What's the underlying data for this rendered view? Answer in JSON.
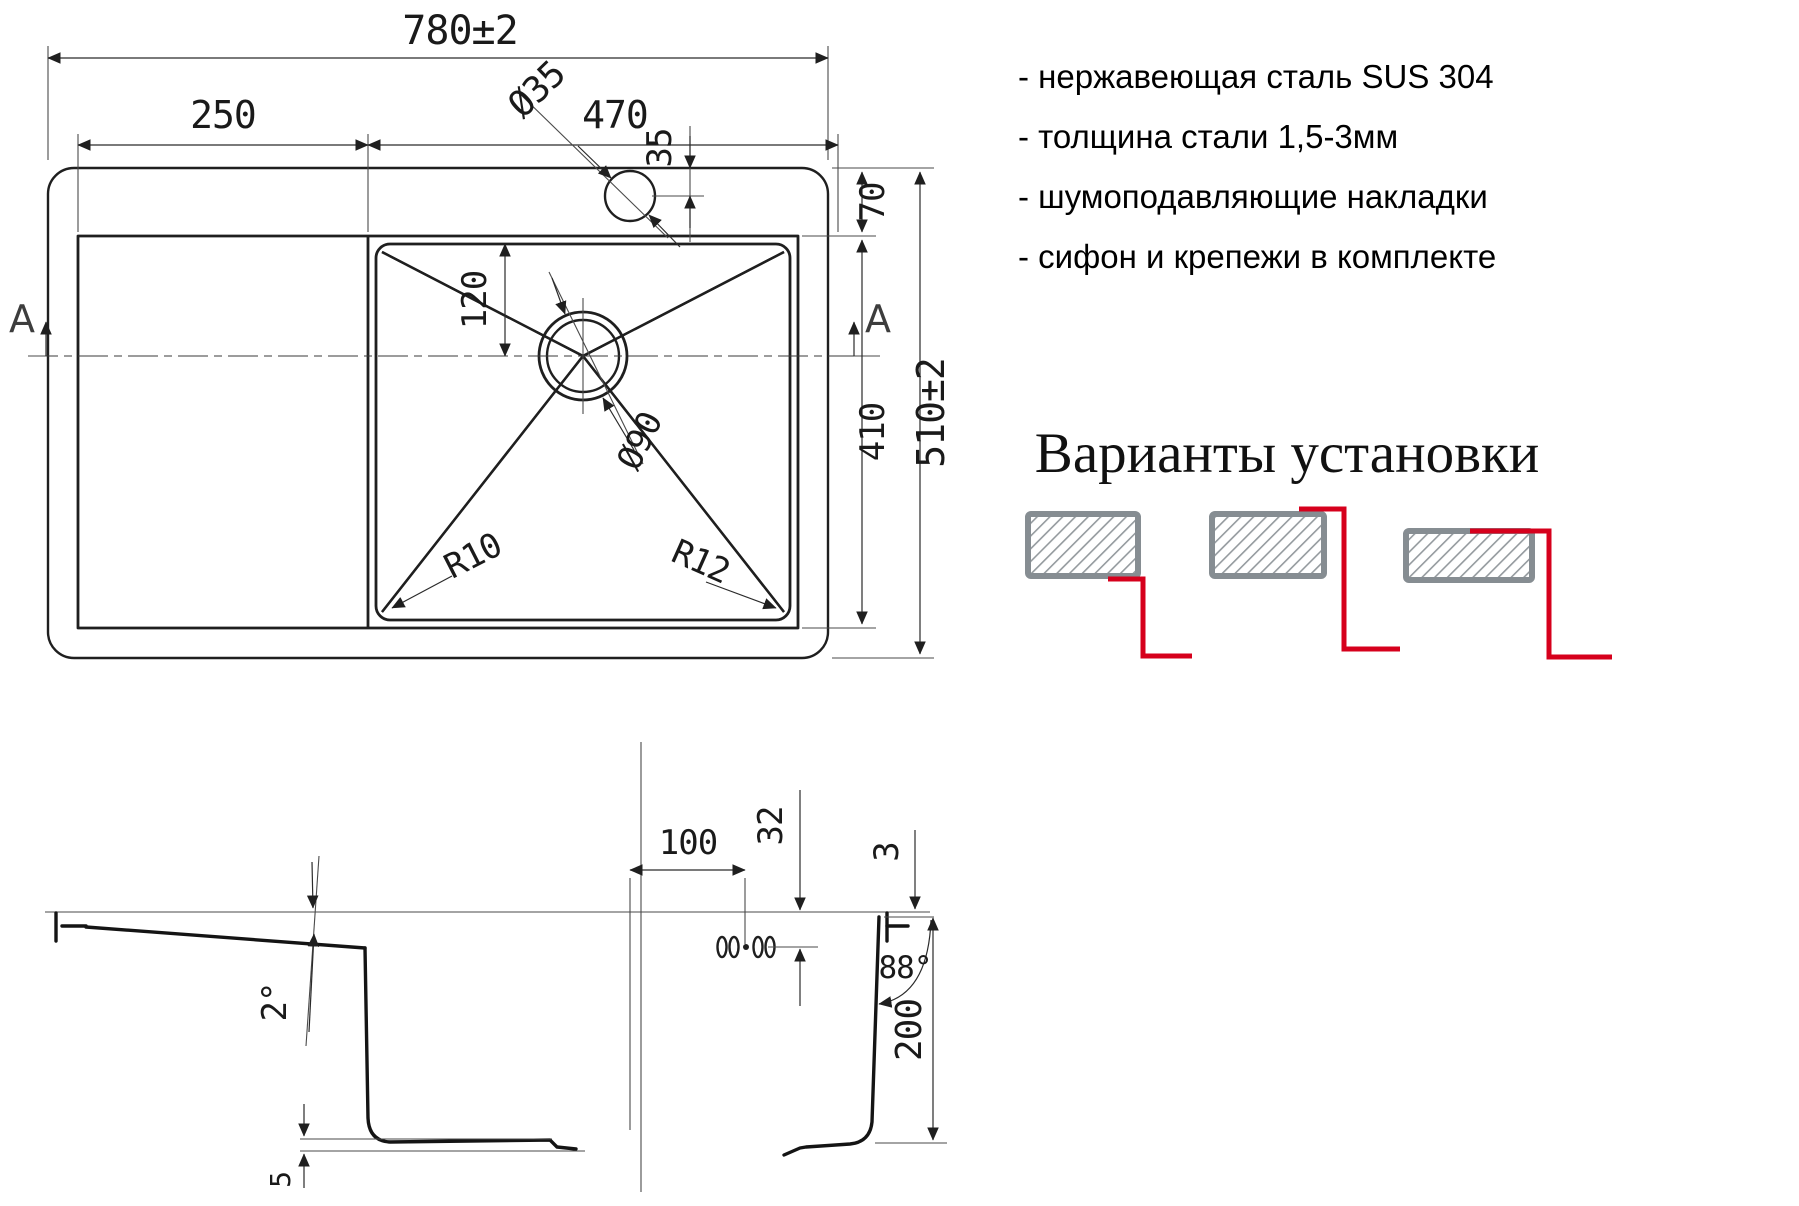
{
  "specs": {
    "items": [
      "- нержавеющая сталь SUS 304",
      "- толщина стали 1,5-3мм",
      "- шумоподавляющие накладки",
      "- сифон и крепежи в комплекте"
    ]
  },
  "install": {
    "title": "Варианты установки"
  },
  "plan": {
    "overall_width": "780±2",
    "drainboard_width": "250",
    "bowl_width": "470",
    "faucet_hole_diameter": "Ø35",
    "faucet_hole_offset": "35",
    "rim_offset_top": "70",
    "drain_offset": "120",
    "drain_diameter": "Ø90",
    "bowl_length": "410",
    "overall_depth": "510±2",
    "corner_radius_left": "R10",
    "corner_radius_right": "R12",
    "section_label_left": "A",
    "section_label_right": "A"
  },
  "section": {
    "holes_offset": "100",
    "holes_depth": "32",
    "rim_height": "3",
    "drainboard_slope": "2°",
    "wall_angle": "88°",
    "bowl_depth": "200",
    "bottom_clearance": "5"
  },
  "colors": {
    "line": "#1f1f1f",
    "thin_line": "#4a4a4a",
    "accent_red": "#d6001c",
    "hatch_gray": "#868d92"
  }
}
